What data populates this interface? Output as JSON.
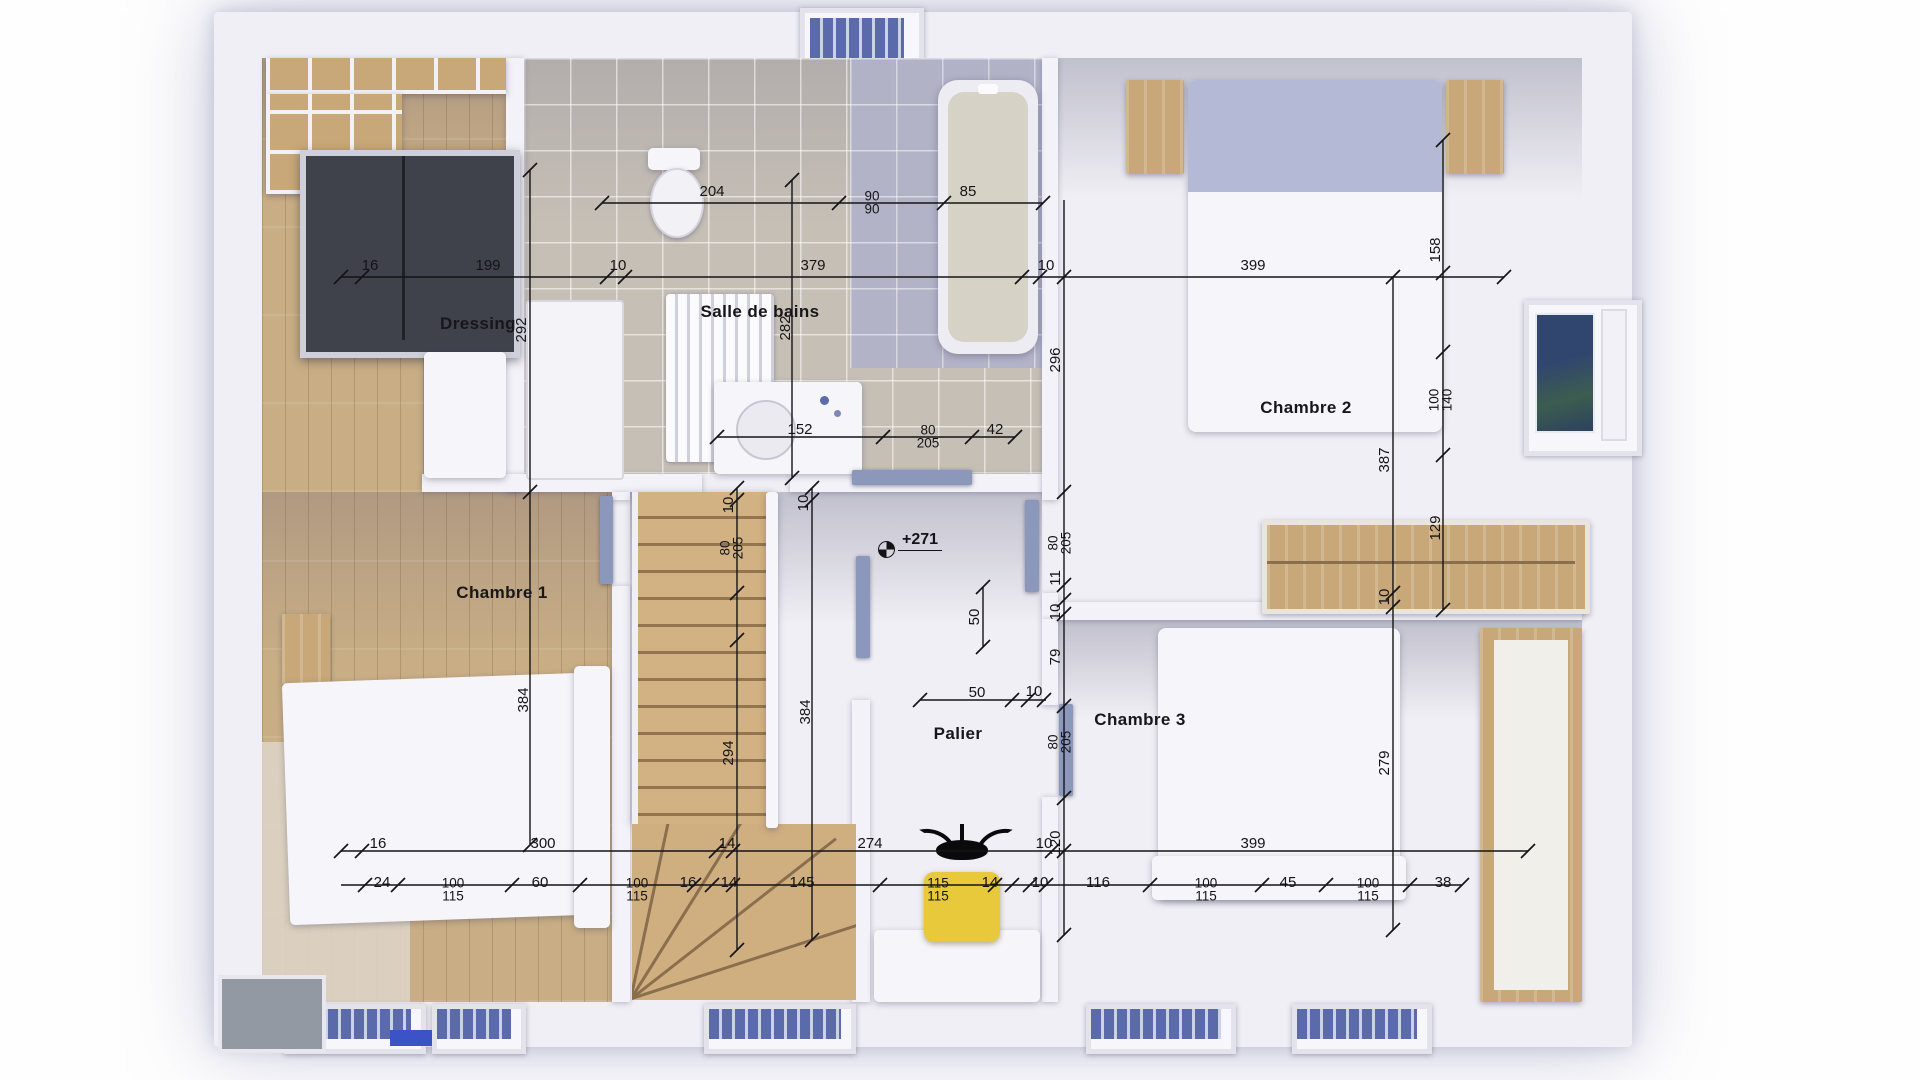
{
  "rooms": {
    "dressing": "Dressing",
    "bathroom": "Salle de bains",
    "bedroom1": "Chambre 1",
    "bedroom2": "Chambre 2",
    "bedroom3": "Chambre 3",
    "landing": "Palier"
  },
  "level_marker": {
    "text": "+271"
  },
  "colors": {
    "ink": "#141416",
    "wall_white": "#f3f2f8",
    "wood_floor": "#c9ae85",
    "bath_tile": "#c6bfb6",
    "bath_tile_blue": "#b2b3c9",
    "door_blue": "#8b97bb",
    "window_blue": "#5b6aaa",
    "stool_yellow": "#e9c93c",
    "duvet_white": "#f6f5fa",
    "pillow_blue": "#b4bad6",
    "wardrobe_dark": "#3f414b"
  },
  "dim_labels": [
    {
      "t": "204",
      "x": 712,
      "y": 192
    },
    {
      "t": "90",
      "t2": "90",
      "x": 872,
      "y": 203
    },
    {
      "t": "85",
      "x": 968,
      "y": 192
    },
    {
      "t": "16",
      "x": 370,
      "y": 266
    },
    {
      "t": "199",
      "x": 488,
      "y": 266
    },
    {
      "t": "10",
      "x": 618,
      "y": 266
    },
    {
      "t": "379",
      "x": 813,
      "y": 266
    },
    {
      "t": "10",
      "x": 1046,
      "y": 266
    },
    {
      "t": "399",
      "x": 1253,
      "y": 266
    },
    {
      "t": "152",
      "x": 800,
      "y": 430
    },
    {
      "t": "80",
      "t2": "205",
      "x": 928,
      "y": 437
    },
    {
      "t": "42",
      "x": 995,
      "y": 430
    },
    {
      "t": "50",
      "x": 977,
      "y": 693
    },
    {
      "t": "10",
      "x": 1034,
      "y": 692
    },
    {
      "t": "16",
      "x": 378,
      "y": 844
    },
    {
      "t": "300",
      "x": 543,
      "y": 844
    },
    {
      "t": "14",
      "x": 727,
      "y": 844
    },
    {
      "t": "274",
      "x": 870,
      "y": 844
    },
    {
      "t": "10",
      "x": 1044,
      "y": 844
    },
    {
      "t": "399",
      "x": 1253,
      "y": 844
    },
    {
      "t": "24",
      "x": 382,
      "y": 883
    },
    {
      "t": "100",
      "t2": "115",
      "x": 453,
      "y": 890
    },
    {
      "t": "60",
      "x": 540,
      "y": 883
    },
    {
      "t": "100",
      "t2": "115",
      "x": 637,
      "y": 890
    },
    {
      "t": "16",
      "x": 688,
      "y": 883
    },
    {
      "t": "14",
      "x": 729,
      "y": 883
    },
    {
      "t": "145",
      "x": 802,
      "y": 883
    },
    {
      "t": "115",
      "t2": "115",
      "x": 938,
      "y": 890
    },
    {
      "t": "14",
      "x": 990,
      "y": 883
    },
    {
      "t": "10",
      "x": 1040,
      "y": 883
    },
    {
      "t": "116",
      "x": 1098,
      "y": 883
    },
    {
      "t": "100",
      "t2": "115",
      "x": 1206,
      "y": 890
    },
    {
      "t": "45",
      "x": 1288,
      "y": 883
    },
    {
      "t": "100",
      "t2": "115",
      "x": 1368,
      "y": 890
    },
    {
      "t": "38",
      "x": 1443,
      "y": 883
    },
    {
      "t": "292",
      "x": 522,
      "y": 330,
      "r": -90
    },
    {
      "t": "384",
      "x": 524,
      "y": 700,
      "r": -90
    },
    {
      "t": "282",
      "x": 786,
      "y": 328,
      "r": -90
    },
    {
      "t": "10",
      "x": 729,
      "y": 505,
      "r": -90
    },
    {
      "t": "80",
      "t2": "205",
      "x": 732,
      "y": 548,
      "r": -90
    },
    {
      "t": "294",
      "x": 729,
      "y": 753,
      "r": -90
    },
    {
      "t": "10",
      "x": 804,
      "y": 503,
      "r": -90
    },
    {
      "t": "384",
      "x": 806,
      "y": 712,
      "r": -90
    },
    {
      "t": "50",
      "x": 975,
      "y": 617,
      "r": -90
    },
    {
      "t": "296",
      "x": 1056,
      "y": 360,
      "r": -90
    },
    {
      "t": "80",
      "t2": "205",
      "x": 1060,
      "y": 543,
      "r": -90
    },
    {
      "t": "11",
      "x": 1056,
      "y": 578,
      "r": -90
    },
    {
      "t": "10",
      "x": 1056,
      "y": 612,
      "r": -90
    },
    {
      "t": "79",
      "x": 1056,
      "y": 657,
      "r": -90
    },
    {
      "t": "80",
      "t2": "205",
      "x": 1060,
      "y": 742,
      "r": -90
    },
    {
      "t": "120",
      "x": 1056,
      "y": 843,
      "r": -90
    },
    {
      "t": "387",
      "x": 1385,
      "y": 460,
      "r": -90
    },
    {
      "t": "10",
      "x": 1385,
      "y": 597,
      "r": -90
    },
    {
      "t": "279",
      "x": 1385,
      "y": 763,
      "r": -90
    },
    {
      "t": "158",
      "x": 1436,
      "y": 250,
      "r": -90
    },
    {
      "t": "100",
      "t2": "140",
      "x": 1441,
      "y": 400,
      "r": -90
    },
    {
      "t": "129",
      "x": 1436,
      "y": 528,
      "r": -90
    }
  ]
}
